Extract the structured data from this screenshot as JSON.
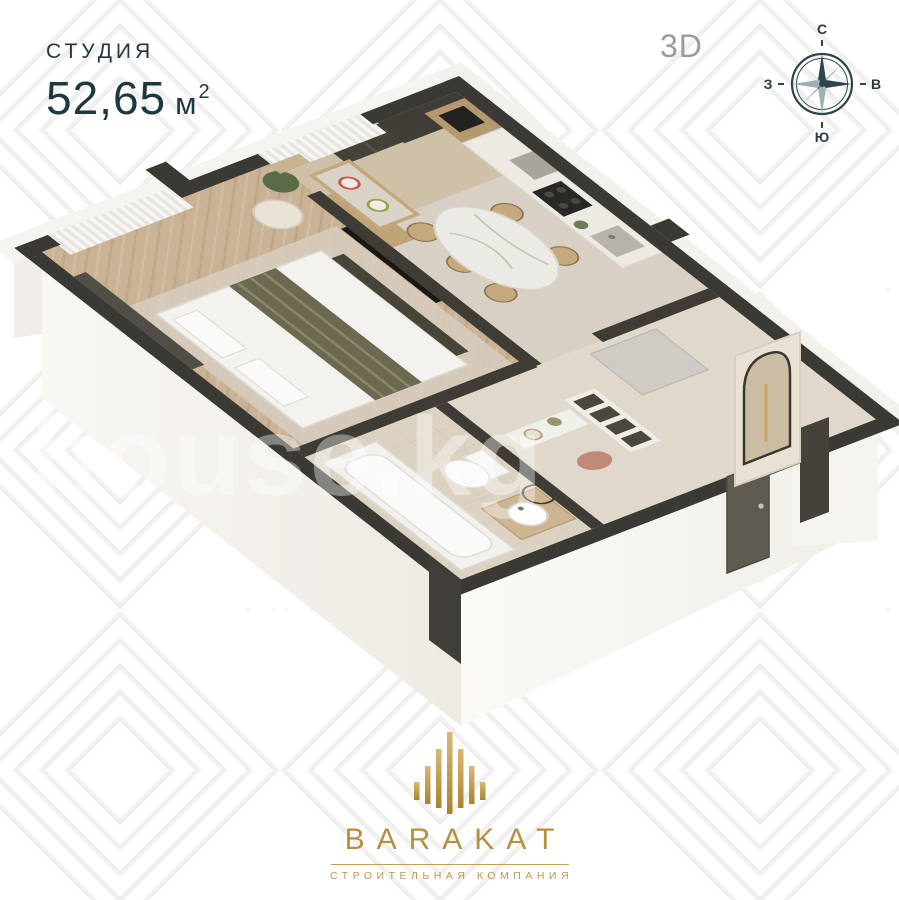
{
  "page": {
    "width": 899,
    "height": 900,
    "background": "#ffffff",
    "pattern_line_color": "#edecea"
  },
  "header": {
    "plan_type_label": "СТУДИЯ",
    "area_value": "52,65",
    "area_unit": "м",
    "area_exponent": "2",
    "title_color": "#1e3a40",
    "view_label": "3D",
    "view_label_color": "#9b9b9b"
  },
  "compass": {
    "color": "#2e454b",
    "labels": {
      "north": "С",
      "east": "В",
      "south": "Ю",
      "west": "З"
    }
  },
  "watermark": {
    "text": "house.kg"
  },
  "floor_plan": {
    "type": "3d-isometric-studio-apartment-cutaway",
    "colors": {
      "wall_top": "#3b3933",
      "wall_exterior": "#f7f5f1",
      "floor_wood": "#c9b295",
      "floor_stone": "#d8d0c4",
      "floor_bath": "#dcd2c2",
      "floor_hall": "#e0d8ca",
      "entrance_door": "#5d5b52",
      "kitchen_wood": "#b5996e",
      "textile_olive": "#6d6950",
      "appliance_dark": "#2a2824"
    }
  },
  "footer": {
    "brand_name": "BARAKAT",
    "brand_tagline": "СТРОИТЕЛЬНАЯ КОМПАНИЯ",
    "gold": "#b5913f"
  }
}
